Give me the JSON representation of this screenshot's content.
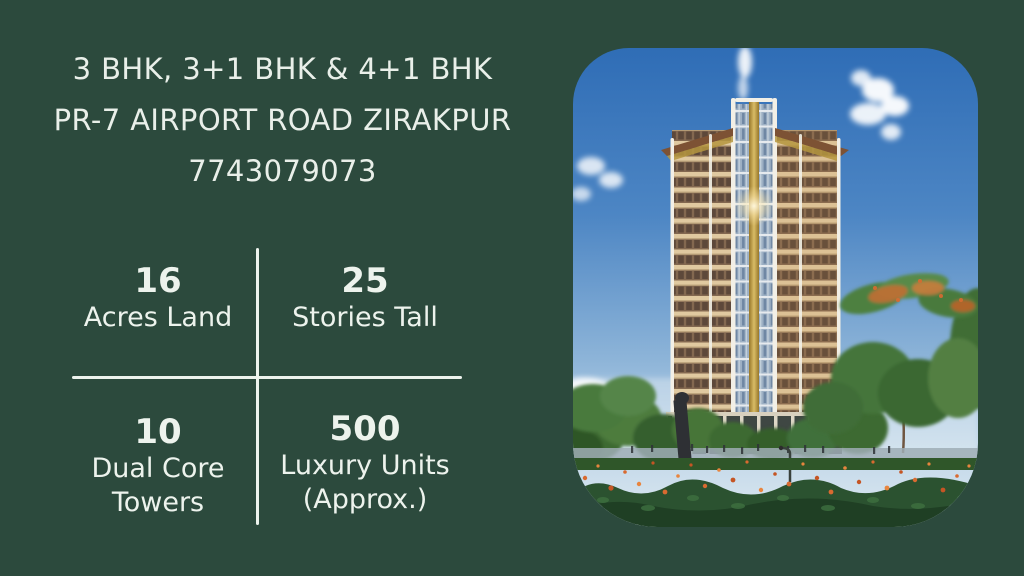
{
  "header": {
    "config_line": "3 BHK, 3+1 BHK & 4+1 BHK",
    "location_line": "PR-7 AIRPORT ROAD ZIRAKPUR",
    "phone": "7743079073"
  },
  "stats": {
    "items": [
      {
        "value": "16",
        "label": "Acres Land"
      },
      {
        "value": "25",
        "label": "Stories Tall"
      },
      {
        "value": "10",
        "label": "Dual Core\nTowers"
      },
      {
        "value": "500",
        "label": "Luxury Units\n(Approx.)"
      }
    ]
  },
  "colors": {
    "background": "#2c4a3d",
    "text": "#e9efe9",
    "divider": "#edf3ed",
    "sky_blue": "#3b77ba",
    "building_tan": "#c9a87e",
    "gold_strip": "#d9bc66",
    "foliage_green": "#3c6a33",
    "flower_orange": "#d96a30"
  }
}
